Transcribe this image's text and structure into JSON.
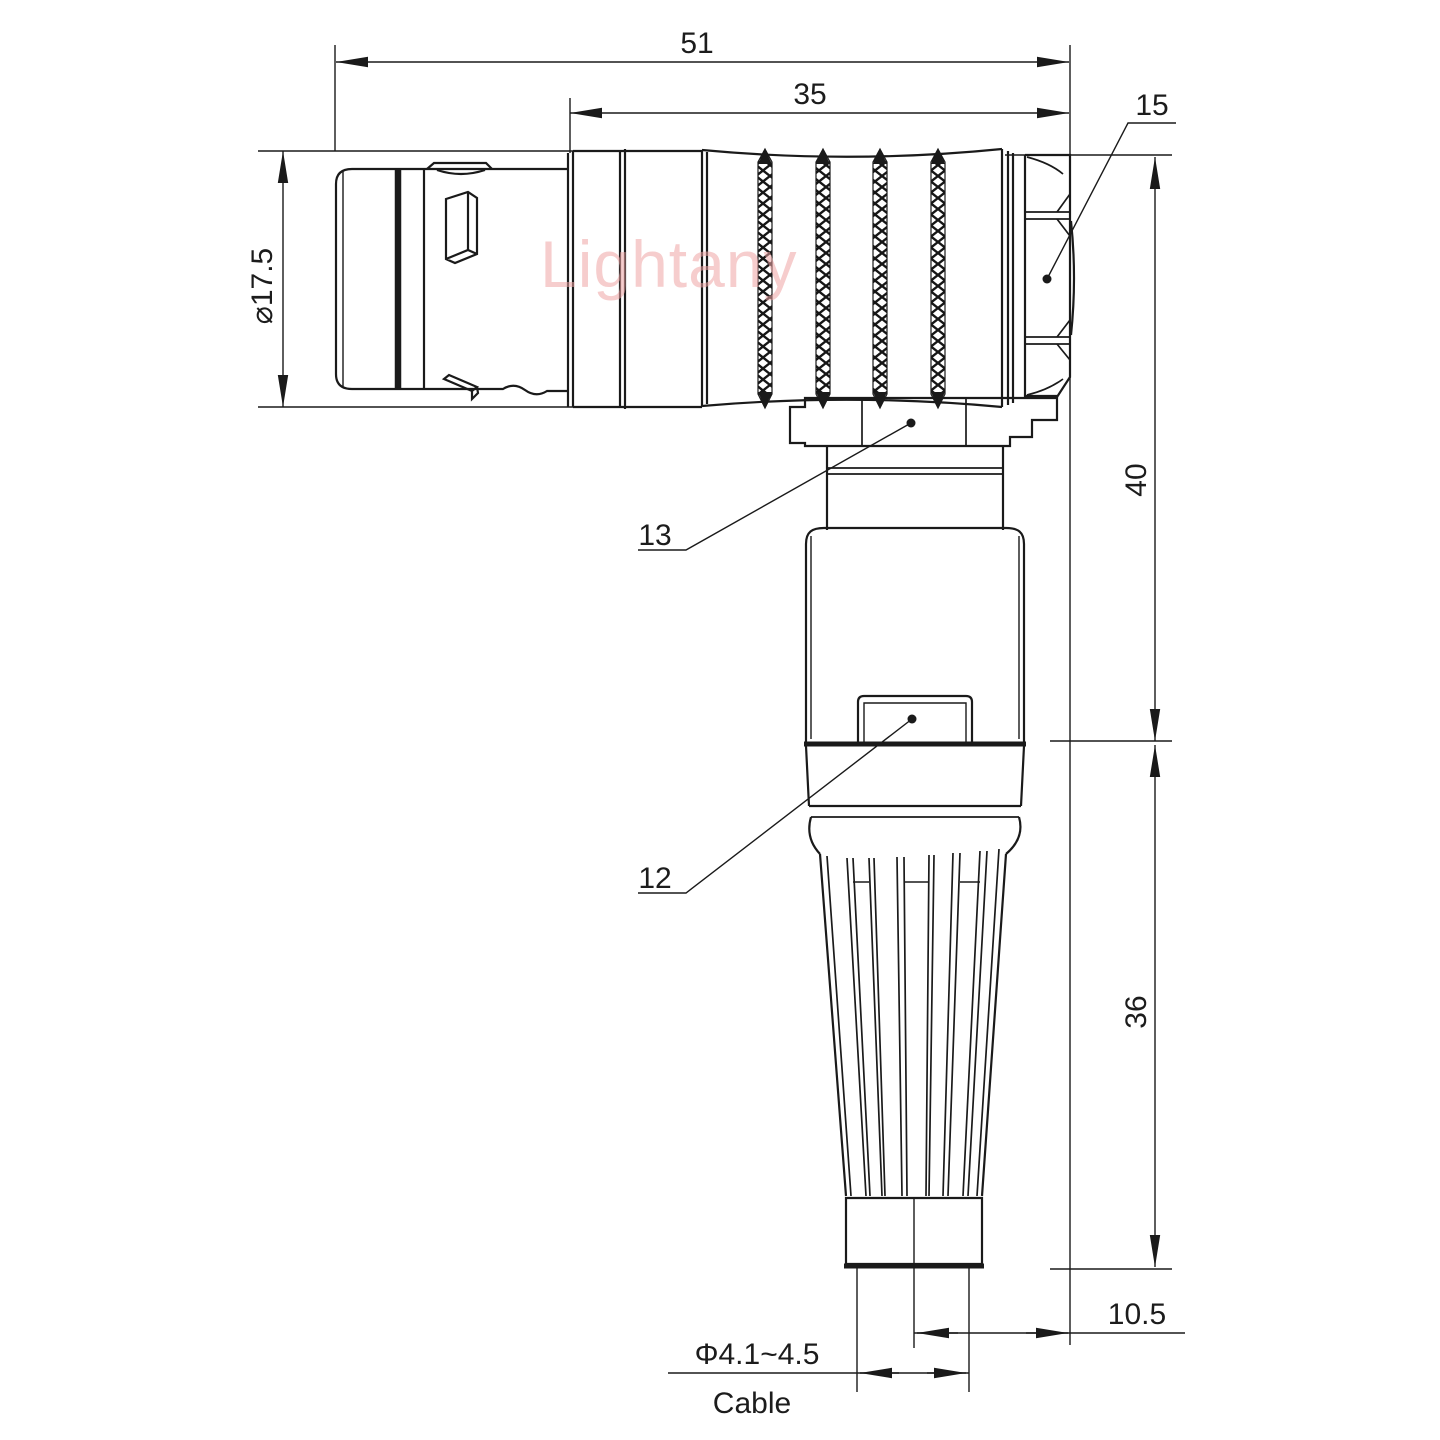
{
  "watermark": {
    "text": "Lightany"
  },
  "engraving": {
    "text": "Lightany"
  },
  "dims": {
    "overall_length": "51",
    "rear_length": "35",
    "part15": "15",
    "front_diameter": "⌀17.5",
    "upper_height": "40",
    "lower_height": "36",
    "part13": "13",
    "part12": "12",
    "cable_offset": "10.5",
    "cable_diameter": "Φ4.1~4.5",
    "cable_word": "Cable"
  },
  "colors": {
    "line": "#1a1a1a",
    "watermark": "#efa5a5"
  }
}
